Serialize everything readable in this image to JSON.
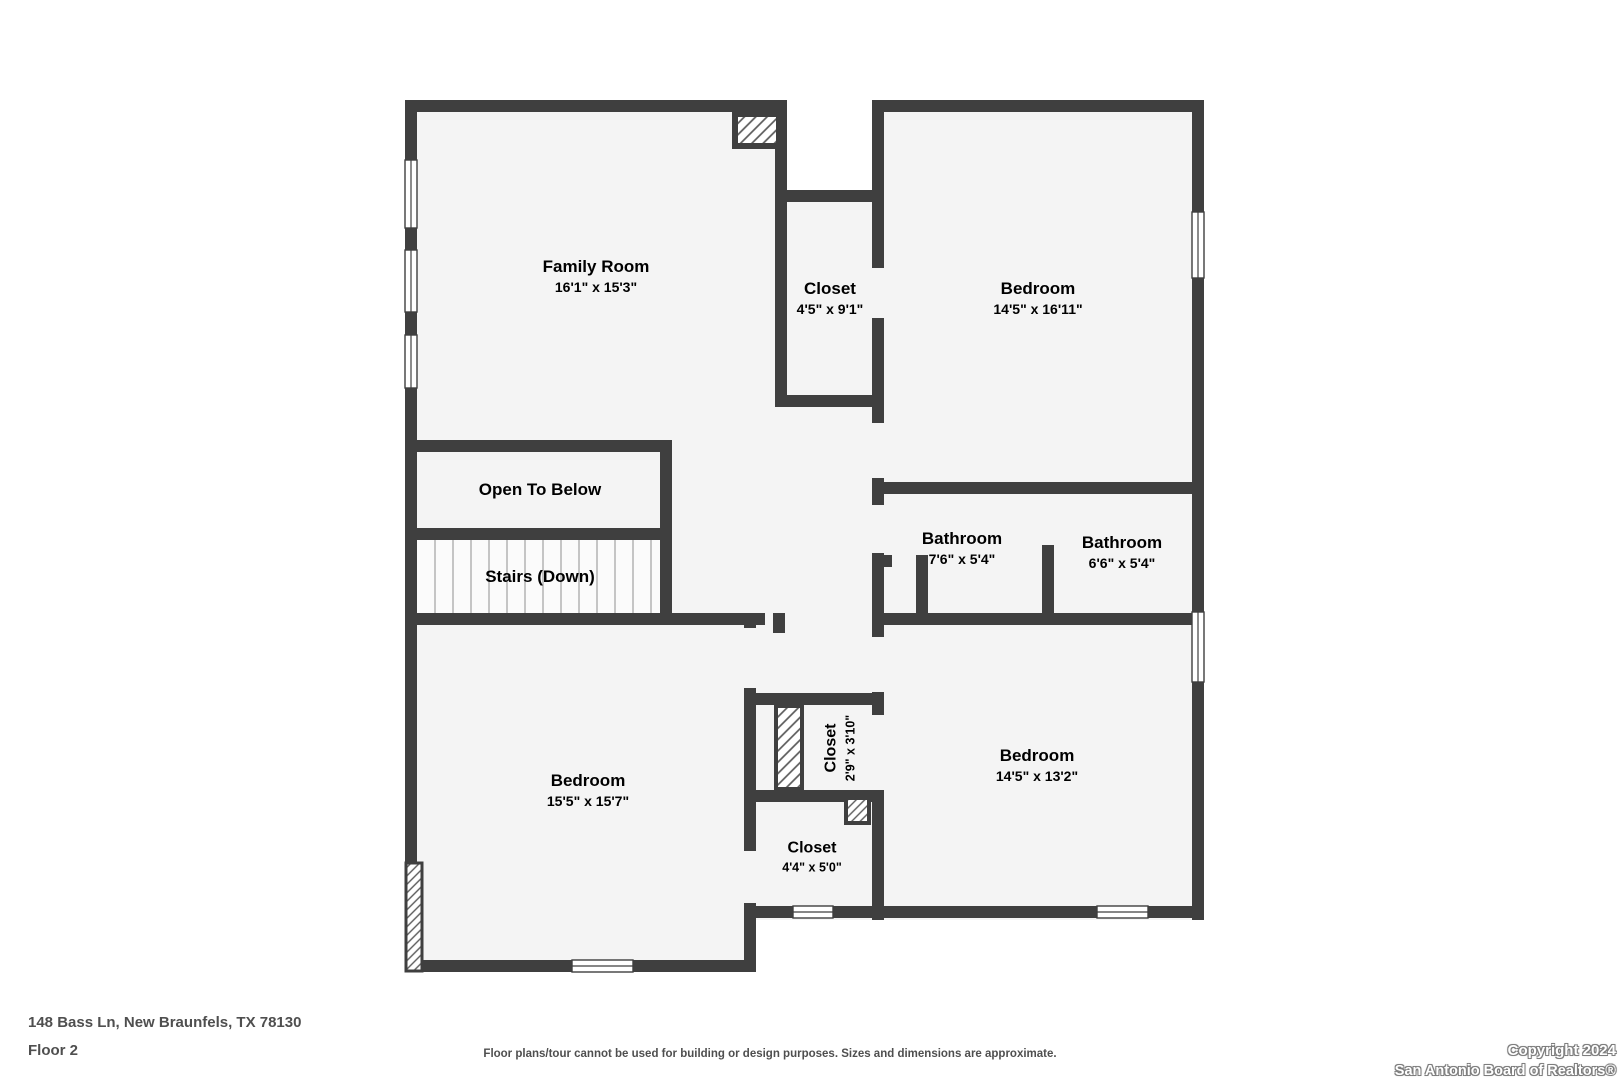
{
  "plan": {
    "address": "148 Bass Ln, New Braunfels, TX 78130",
    "floor_label": "Floor 2",
    "disclaimer": "Floor plans/tour cannot be used for building or design purposes. Sizes and dimensions are approximate.",
    "copyright_line1": "Copyright 2024",
    "copyright_line2": "San Antonio Board of Realtors®",
    "colors": {
      "wall": "#3f3f3f",
      "room_fill": "#f4f4f4",
      "label_text": "#4a4a4a",
      "background": "#ffffff"
    }
  },
  "rooms": {
    "family_room": {
      "name": "Family Room",
      "dims": "16'1\" x 15'3\""
    },
    "closet_top": {
      "name": "Closet",
      "dims": "4'5\" x 9'1\""
    },
    "bedroom_top": {
      "name": "Bedroom",
      "dims": "14'5\" x 16'11\""
    },
    "open_to_below": {
      "name": "Open To Below"
    },
    "stairs": {
      "name": "Stairs (Down)"
    },
    "bathroom_left": {
      "name": "Bathroom",
      "dims": "7'6\" x 5'4\""
    },
    "bathroom_right": {
      "name": "Bathroom",
      "dims": "6'6\" x 5'4\""
    },
    "bedroom_bottom_left": {
      "name": "Bedroom",
      "dims": "15'5\" x 15'7\""
    },
    "closet_rotated": {
      "name": "Closet",
      "dims": "2'9\" x 3'10\""
    },
    "closet_bottom": {
      "name": "Closet",
      "dims": "4'4\" x 5'0\""
    },
    "bedroom_bottom_right": {
      "name": "Bedroom",
      "dims": "14'5\" x 13'2\""
    }
  }
}
